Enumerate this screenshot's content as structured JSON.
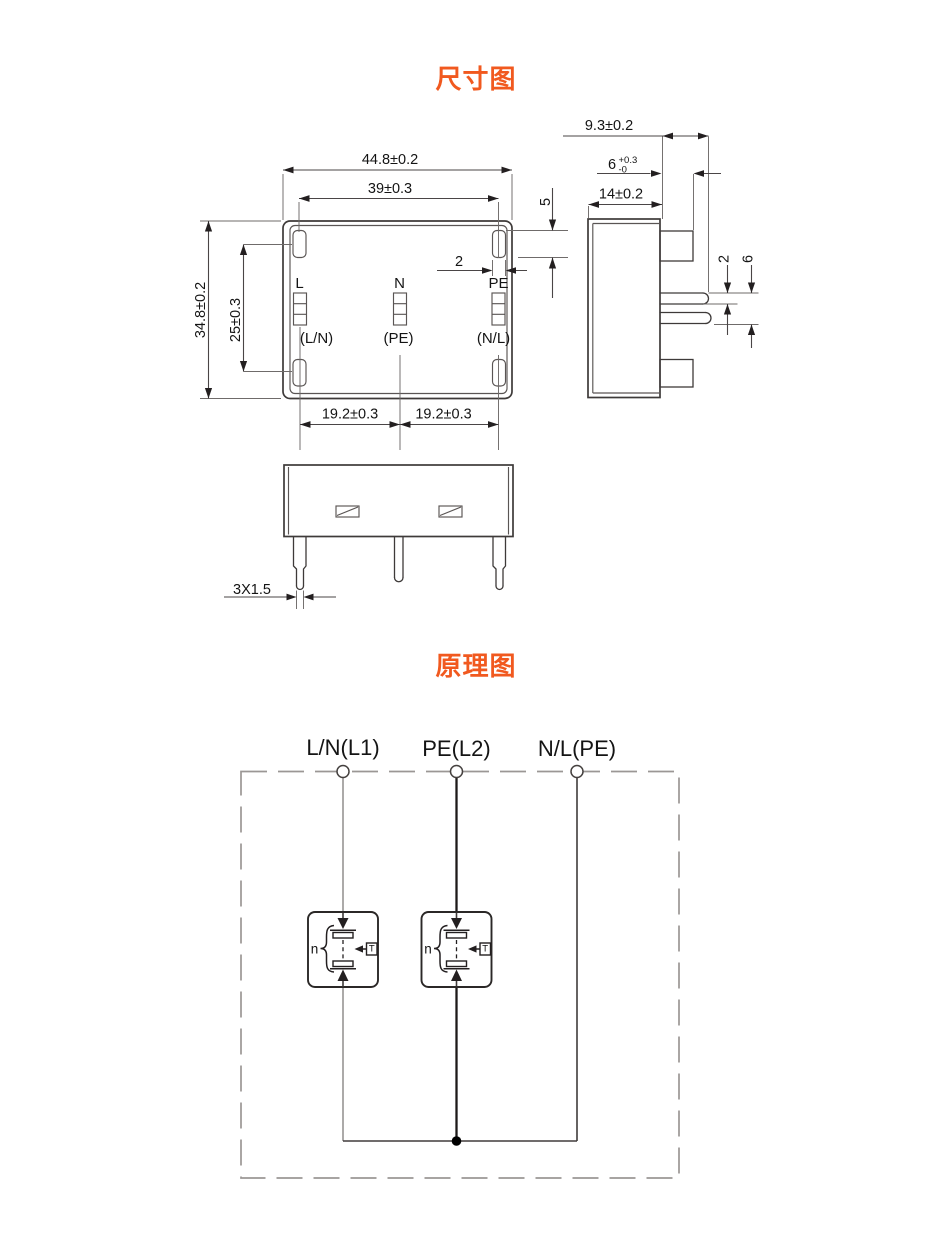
{
  "titles": {
    "dimension_diagram": "尺寸图",
    "schematic_diagram": "原理图"
  },
  "front_view": {
    "dim_overall_width": "44.8±0.2",
    "dim_slot_span": "39±0.3",
    "dim_overall_height": "34.8±0.2",
    "dim_slot_vertical_span": "25±0.3",
    "dim_slot_width": "2",
    "dim_slot_height": "5",
    "dim_pin_pitch_left": "19.2±0.3",
    "dim_pin_pitch_right": "19.2±0.3",
    "pins": [
      {
        "label": "L",
        "sublabel": "(L/N)"
      },
      {
        "label": "N",
        "sublabel": "(PE)"
      },
      {
        "label": "PE",
        "sublabel": "(N/L)"
      }
    ]
  },
  "side_view": {
    "dim_total_depth": "9.3±0.2",
    "dim_tab_depth": "6",
    "dim_tab_tol_upper": "+0.3",
    "dim_tab_tol_lower": "-0",
    "dim_body_depth": "14±0.2",
    "dim_pin_thickness": "2",
    "dim_pins_span": "6"
  },
  "bottom_view": {
    "dim_pin_section": "3X1.5"
  },
  "schematic": {
    "terminals": [
      "L/N(L1)",
      "PE(L2)",
      "N/L(PE)"
    ],
    "units": [
      {
        "gap_count_label": "n",
        "thermal_label": "T"
      },
      {
        "gap_count_label": "n",
        "thermal_label": "T"
      }
    ]
  },
  "colors": {
    "accent": "#f1591f",
    "line": "#3e3a39"
  }
}
